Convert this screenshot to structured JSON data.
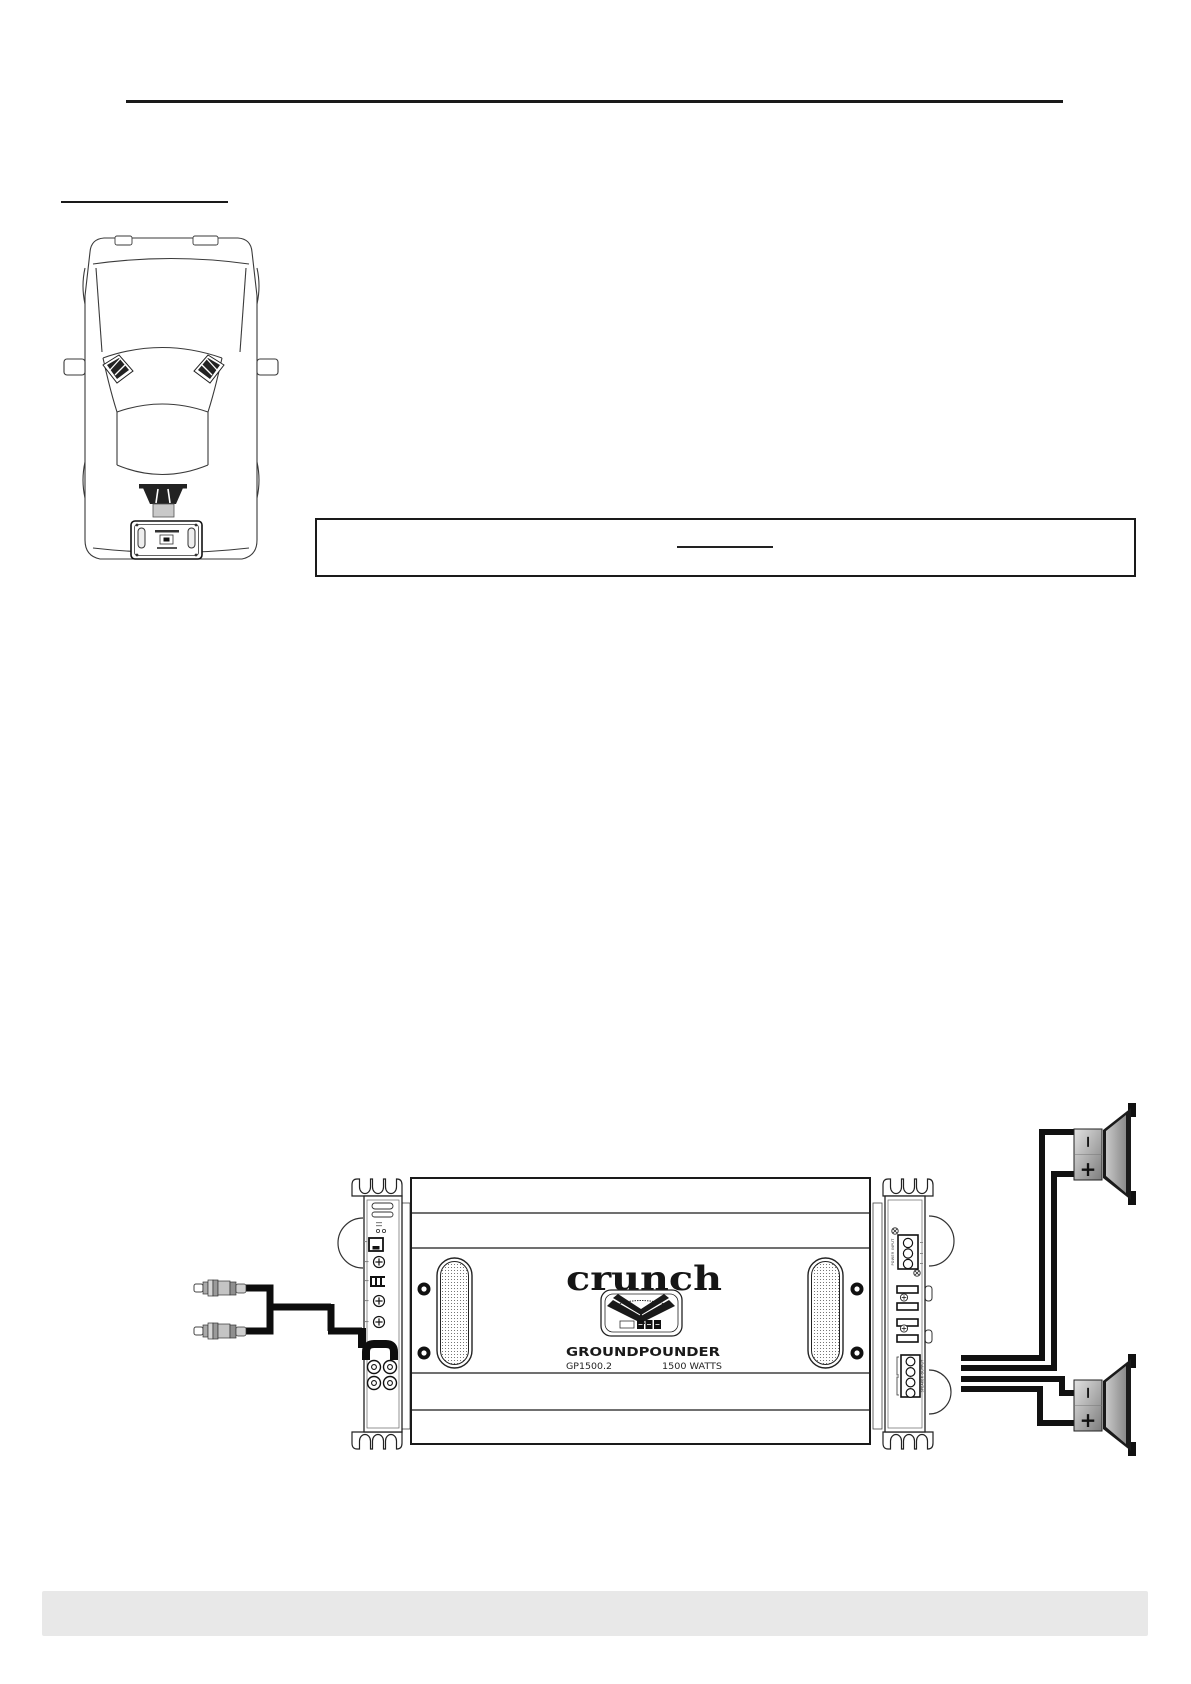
{
  "page": {
    "background": "#ffffff",
    "rule_color": "#1a1a1a",
    "footer_bar_color": "#e8e8e8"
  },
  "amp": {
    "brand": "crunch",
    "series": "GROUNDPOUNDER",
    "model": "GP1500.2",
    "power": "1500 WATTS",
    "power_input_label": "POWER INPUT",
    "speaker_output_label": "SPEAKER OUTPUT"
  },
  "speakers": [
    {
      "neg": "−",
      "pos": "+"
    },
    {
      "neg": "−",
      "pos": "+"
    }
  ],
  "colors": {
    "line": "#1a1a1a",
    "cable": "#0d0d0d",
    "wire": "#111111",
    "speaker_box_light": "#e2e2e2",
    "speaker_box_dark": "#7d7d7d",
    "cone_light": "#c8c8c8",
    "cone_dark": "#8a8a8a",
    "footer_gray": "#e8e8e8"
  }
}
